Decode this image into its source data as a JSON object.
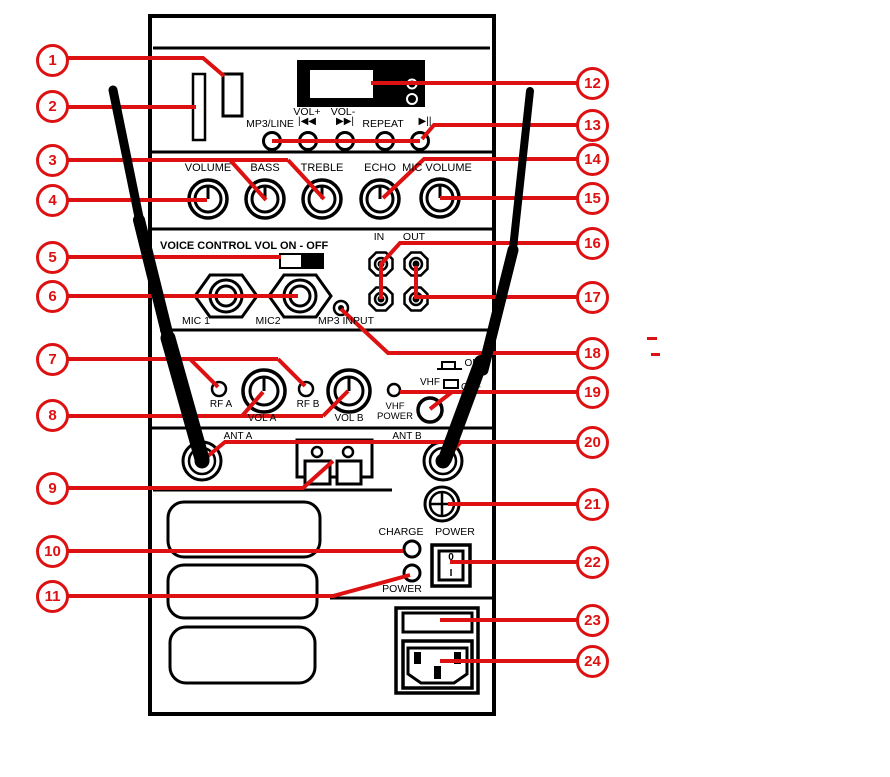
{
  "colors": {
    "callout_red": "#dd1111",
    "ink": "#000000"
  },
  "callouts": [
    "1",
    "2",
    "3",
    "4",
    "5",
    "6",
    "7",
    "8",
    "9",
    "10",
    "11",
    "12",
    "13",
    "14",
    "15",
    "16",
    "17",
    "18",
    "19",
    "20",
    "21",
    "22",
    "23",
    "24"
  ],
  "labels": {
    "mp3_line": "MP3/LINE",
    "vol_plus": "VOL+",
    "prev_icon": "|◀◀",
    "vol_minus": "VOL-",
    "next_icon": "▶▶|",
    "repeat": "REPEAT",
    "play_pause": "▶||",
    "volume": "VOLUME",
    "bass": "BASS",
    "treble": "TREBLE",
    "echo": "ECHO",
    "mic_volume": "MIC VOLUME",
    "voice_control": "VOICE CONTROL VOL ON - OFF",
    "mic1": "MIC 1",
    "mic2": "MIC2",
    "mp3_input": "MP3 INPUT",
    "line_in": "IN",
    "line_out": "OUT",
    "rf_a": "RF A",
    "vol_a": "VOL A",
    "rf_b": "RF B",
    "vol_b": "VOL B",
    "vhf_power_1": "VHF",
    "vhf_power_2": "POWER",
    "switch_on": "ON",
    "vhf": "VHF",
    "switch_off": "OFF",
    "ant_a": "ANT A",
    "ant_b": "ANT B",
    "charge": "CHARGE",
    "power_switch": "POWER",
    "rocker_off": "0",
    "rocker_on": "I",
    "power_led": "POWER"
  }
}
